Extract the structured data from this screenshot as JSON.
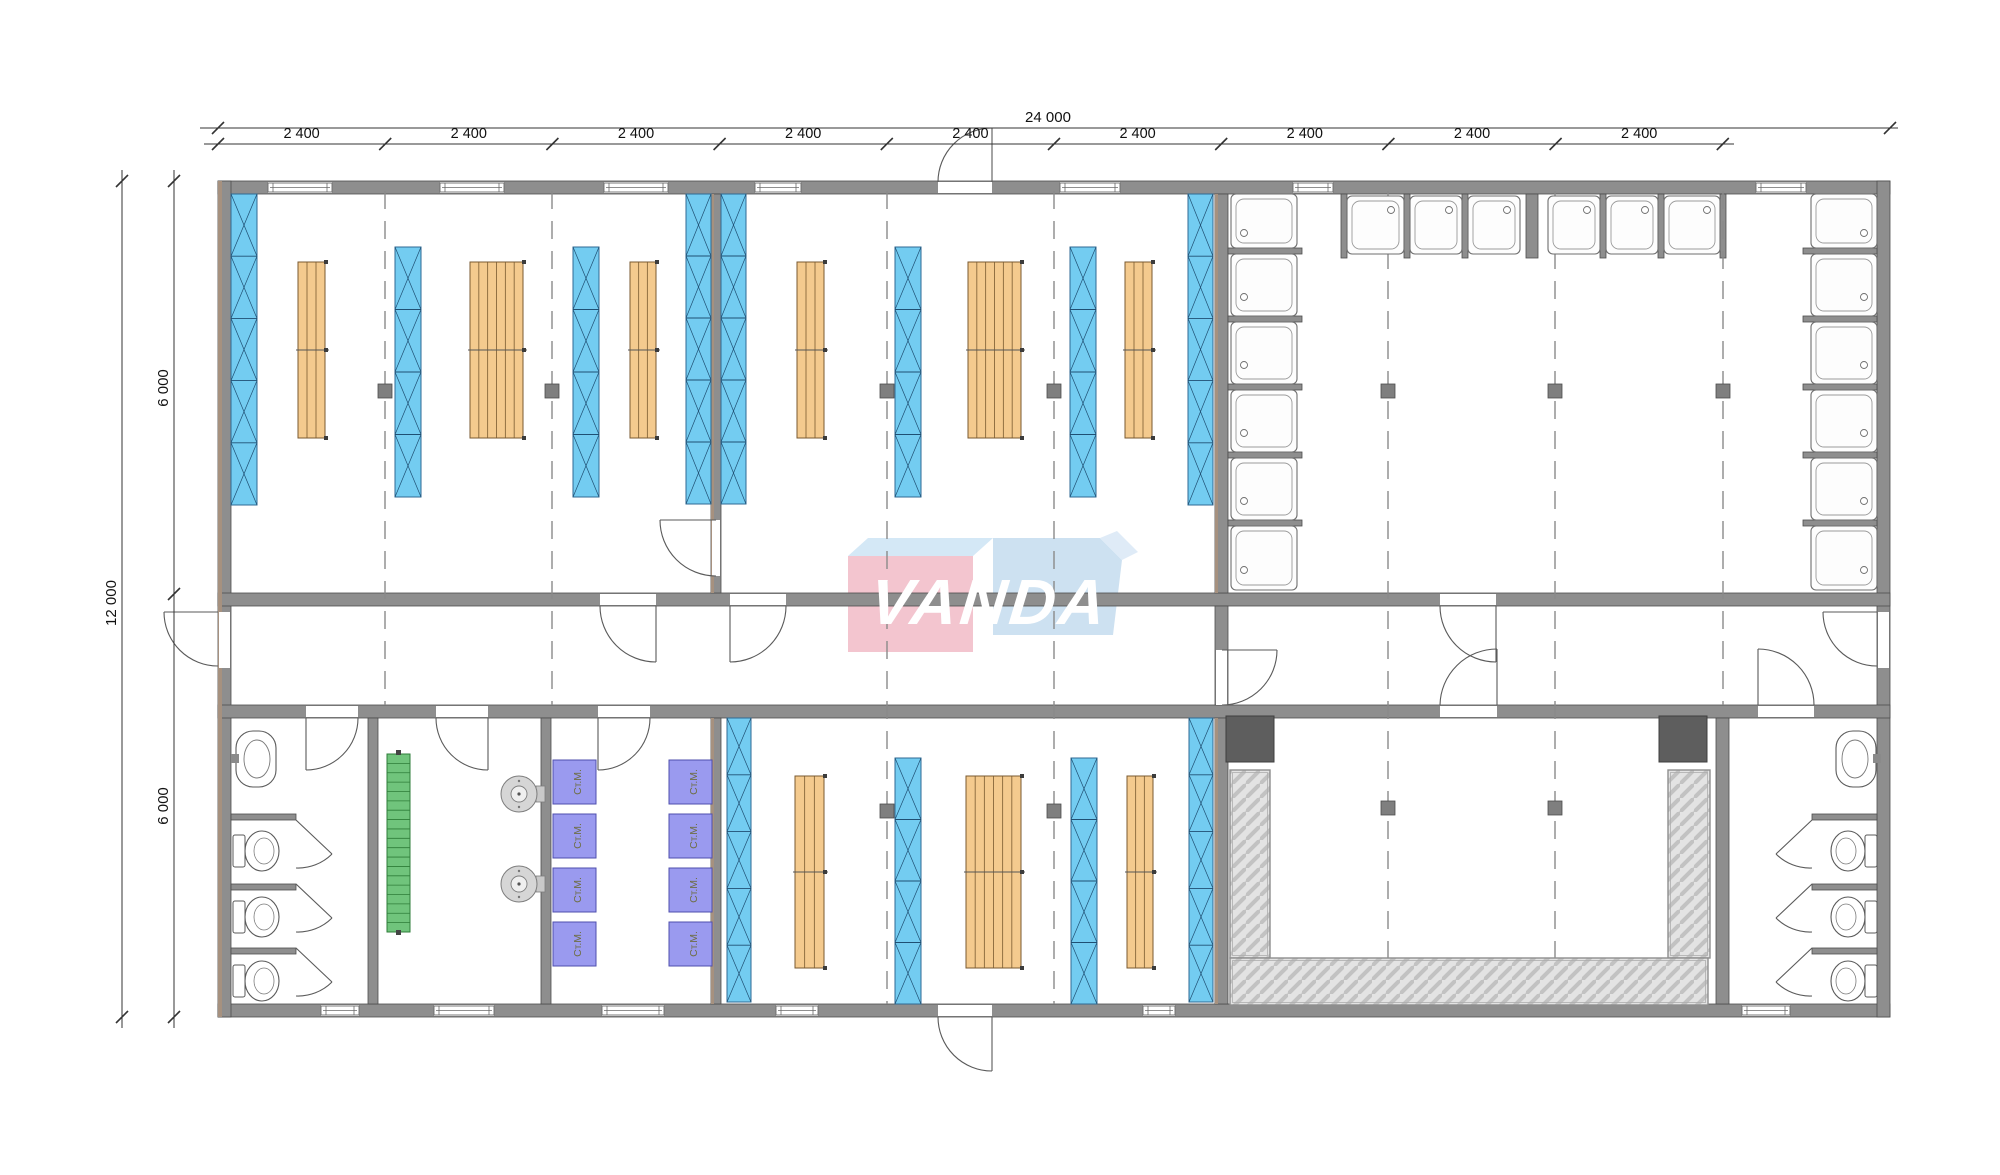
{
  "drawing": {
    "kind": "modular building floor plan",
    "background": "#ffffff"
  },
  "logo": {
    "text": "VANDA"
  },
  "dimensions": {
    "overall_width_mm": "24 000",
    "module_width_mm": "2 400",
    "module_label_count": 9,
    "overall_depth_mm": "12 000",
    "half_depth_mm": "6 000"
  },
  "equipment_labels": {
    "washing_machine": "Ст.М."
  },
  "fixtures": {
    "showers": 18,
    "toilets": 6,
    "washing_machines": 8,
    "sinks": 2,
    "water_heaters": 2
  },
  "colors": {
    "wall": "#8e8e8e",
    "wall_edge": "#4d4d4d",
    "wall_outer_face": "#a6917f",
    "panel_blue": "#73ccf1",
    "panel_blue_line": "#1f4f73",
    "wood": "#f4ca8e",
    "wood_line": "#7a5a30",
    "green": "#70c47c",
    "green_line": "#2e7d38",
    "washer_purple": "#9a9aef",
    "washer_border": "#4f4fae",
    "washer_text": "#6e6e45",
    "counter_fill": "#e3e3e3",
    "counter_hatch": "#c2c2c2",
    "dark_equipment": "#5e5e5e",
    "logo_pink": "#f2c0cb",
    "logo_blue": "#c9def0",
    "logo_bevel": "#cfe6f5",
    "dim_text": "#111111"
  }
}
